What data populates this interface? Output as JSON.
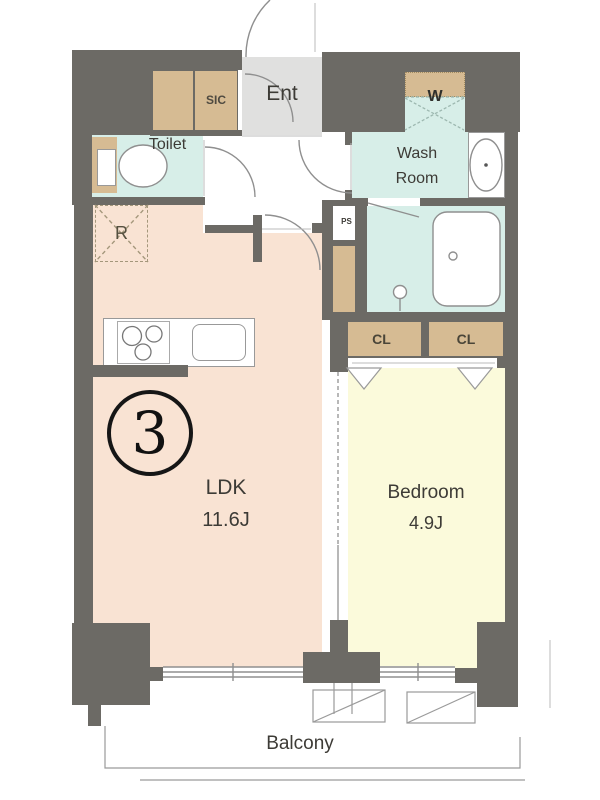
{
  "floor_plan": {
    "unit_number": "3",
    "rooms": {
      "entrance": {
        "label": "Ent"
      },
      "shoe_closet": {
        "label": "SIC"
      },
      "toilet": {
        "label": "Toilet"
      },
      "washroom": {
        "line1": "Wash",
        "line2": "Room"
      },
      "washer": {
        "label": "W"
      },
      "pipe_space": {
        "label": "PS"
      },
      "refrigerator": {
        "label": "R"
      },
      "ldk": {
        "label": "LDK",
        "size": "11.6J"
      },
      "bedroom": {
        "label": "Bedroom",
        "size": "4.9J"
      },
      "closet_left": {
        "label": "CL"
      },
      "closet_right": {
        "label": "CL"
      },
      "balcony": {
        "label": "Balcony"
      }
    },
    "colors": {
      "wall": "#6c6a65",
      "ldk_floor": "#f9e3d3",
      "bedroom_floor": "#fbfadb",
      "wet_floor": "#d7eee8",
      "closet": "#d6bb93",
      "entrance_floor": "#e0e0df",
      "outline": "#8f8f8f",
      "text": "#3d3b36"
    }
  }
}
